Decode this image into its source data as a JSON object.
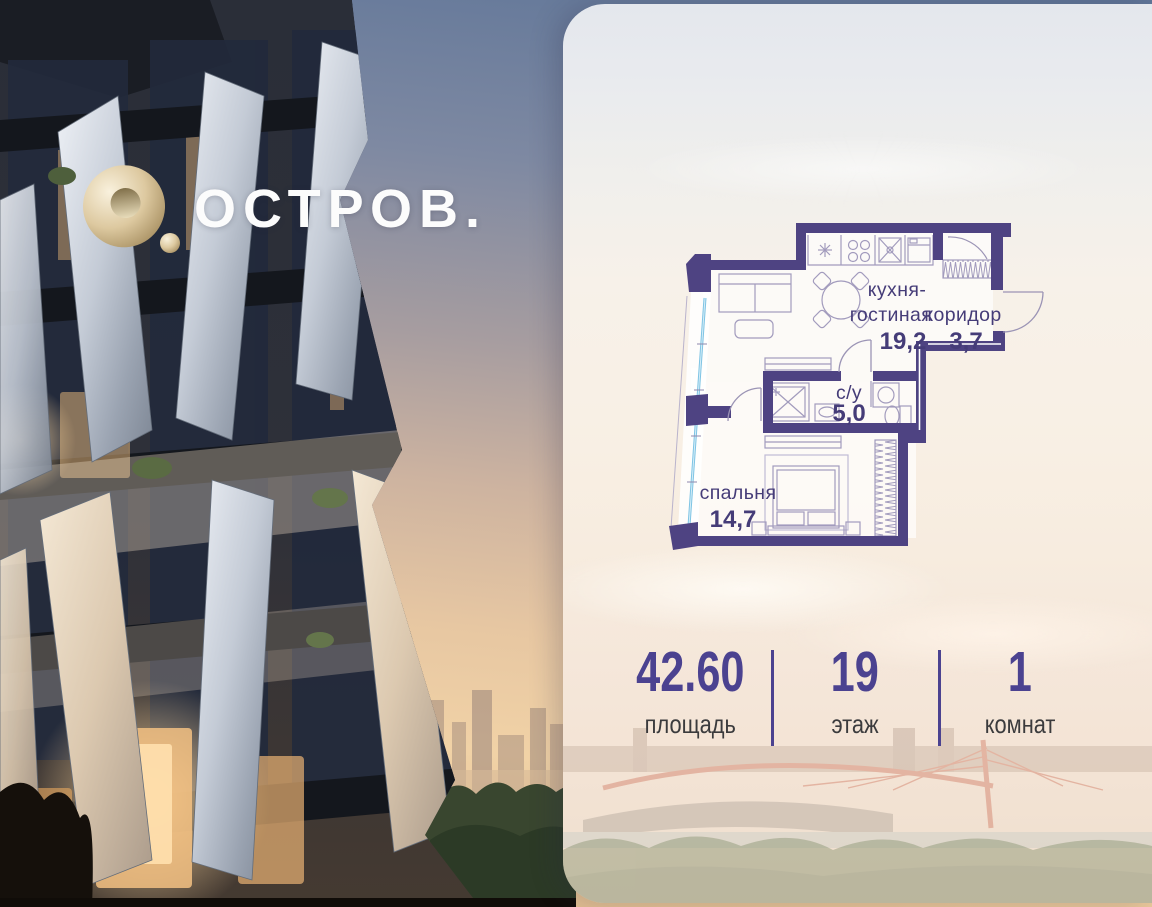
{
  "brand": {
    "logo_text": "ОСТРОВ.",
    "logo_icon": "gold-torus-ring"
  },
  "floor_plan": {
    "rooms": [
      {
        "id": "kitchen-living",
        "name_lines": [
          "кухня-",
          "гостиная"
        ],
        "area": "19,2"
      },
      {
        "id": "corridor",
        "name_lines": [
          "коридор"
        ],
        "area": "3,7"
      },
      {
        "id": "bathroom",
        "name_lines": [
          "с/у"
        ],
        "area": "5,0"
      },
      {
        "id": "bedroom",
        "name_lines": [
          "спальня"
        ],
        "area": "14,7"
      }
    ]
  },
  "stats": [
    {
      "value": "42.60",
      "label": "площадь"
    },
    {
      "value": "19",
      "label": "этаж"
    },
    {
      "value": "1",
      "label": "комнат"
    }
  ],
  "colors": {
    "wall_purple": "#4e4382",
    "accent_purple": "#4b4290",
    "label_purple": "#453c78",
    "glazing_blue": "#7fc4e4",
    "logo_gold": "#d8c49a",
    "label_dark": "#3b3b3d"
  }
}
